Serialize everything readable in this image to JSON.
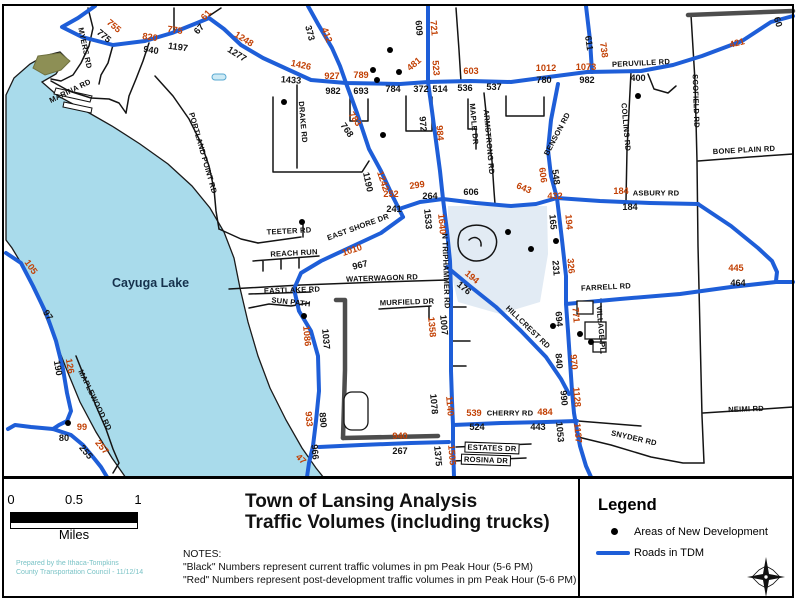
{
  "colors": {
    "roads_tdm_blue": "#1e5ed8",
    "current_volume_black": "#141414",
    "post_development_red": "#c24105",
    "lake_fill": "#a9dbeb",
    "boundary_gray": "#4d4d4d",
    "credit_teal": "#7ac3c6",
    "development_shade": "#e2ebf4"
  },
  "map": {
    "lake_label": "Cayuga Lake",
    "road_labels": [
      {
        "t": "MYERS RD",
        "x": 85,
        "y": 48,
        "r": 78
      },
      {
        "t": "MARINA RD",
        "x": 70,
        "y": 91,
        "r": -26
      },
      {
        "t": "PORTLAND POINT RD",
        "x": 203,
        "y": 153,
        "r": 74
      },
      {
        "t": "DRAKE RD",
        "x": 303,
        "y": 122,
        "r": 85
      },
      {
        "t": "TEETER RD",
        "x": 289,
        "y": 231,
        "r": -3
      },
      {
        "t": "EAST SHORE DR",
        "x": 358,
        "y": 227,
        "r": -20
      },
      {
        "t": "REACH RUN",
        "x": 294,
        "y": 253,
        "r": -3
      },
      {
        "t": "EASTLAKE RD",
        "x": 292,
        "y": 290,
        "r": -2
      },
      {
        "t": "SUN PATH",
        "x": 291,
        "y": 302,
        "r": 6
      },
      {
        "t": "WATERWAGON RD",
        "x": 382,
        "y": 278,
        "r": -2
      },
      {
        "t": "MURFIELD DR",
        "x": 407,
        "y": 302,
        "r": -2
      },
      {
        "t": "MAPLE DR",
        "x": 474,
        "y": 124,
        "r": 85
      },
      {
        "t": "ARMSTRONG RD",
        "x": 489,
        "y": 142,
        "r": 85
      },
      {
        "t": "BENSON RD",
        "x": 557,
        "y": 134,
        "r": -62
      },
      {
        "t": "COLLINS RD",
        "x": 626,
        "y": 127,
        "r": 85
      },
      {
        "t": "SCOFIELD RD",
        "x": 696,
        "y": 101,
        "r": 88
      },
      {
        "t": "PERUVILLE RD",
        "x": 641,
        "y": 63,
        "r": -3
      },
      {
        "t": "BONE PLAIN RD",
        "x": 744,
        "y": 150,
        "r": -3
      },
      {
        "t": "ASBURY RD",
        "x": 656,
        "y": 193,
        "r": 0
      },
      {
        "t": "FARRELL RD",
        "x": 606,
        "y": 287,
        "r": -3
      },
      {
        "t": "VILLAGE PL",
        "x": 601,
        "y": 329,
        "r": 85
      },
      {
        "t": "HILLCREST RD",
        "x": 528,
        "y": 327,
        "r": 44
      },
      {
        "t": "CHERRY RD",
        "x": 510,
        "y": 413,
        "r": 0
      },
      {
        "t": "SNYDER RD",
        "x": 634,
        "y": 438,
        "r": 13
      },
      {
        "t": "NEIMI RD",
        "x": 746,
        "y": 409,
        "r": -2
      },
      {
        "t": "ESTATES DR",
        "x": 492,
        "y": 448,
        "r": 2,
        "box": true
      },
      {
        "t": "ROSINA DR",
        "x": 486,
        "y": 460,
        "r": 2,
        "box": true
      },
      {
        "t": "MAPLEWOOD RD",
        "x": 95,
        "y": 400,
        "r": 64
      },
      {
        "t": "N TRIPHAMMER RD",
        "x": 446,
        "y": 271,
        "r": 88
      }
    ],
    "traffic_numbers": [
      {
        "v": "755",
        "c": "r",
        "x": 114,
        "y": 26,
        "r": 40
      },
      {
        "v": "775",
        "c": "b",
        "x": 104,
        "y": 36,
        "r": 40
      },
      {
        "v": "820",
        "c": "r",
        "x": 150,
        "y": 37,
        "r": 8
      },
      {
        "v": "775",
        "c": "r",
        "x": 175,
        "y": 30,
        "r": 8
      },
      {
        "v": "940",
        "c": "b",
        "x": 151,
        "y": 50,
        "r": 8
      },
      {
        "v": "1197",
        "c": "b",
        "x": 178,
        "y": 47,
        "r": 8
      },
      {
        "v": "61",
        "c": "r",
        "x": 206,
        "y": 15,
        "r": -48
      },
      {
        "v": "67",
        "c": "b",
        "x": 199,
        "y": 29,
        "r": -48
      },
      {
        "v": "1248",
        "c": "r",
        "x": 244,
        "y": 39,
        "r": 32
      },
      {
        "v": "1277",
        "c": "b",
        "x": 237,
        "y": 54,
        "r": 32
      },
      {
        "v": "373",
        "c": "b",
        "x": 310,
        "y": 33,
        "r": 75
      },
      {
        "v": "412",
        "c": "r",
        "x": 327,
        "y": 35,
        "r": 70
      },
      {
        "v": "609",
        "c": "b",
        "x": 419,
        "y": 28,
        "r": 85
      },
      {
        "v": "721",
        "c": "r",
        "x": 434,
        "y": 28,
        "r": 85
      },
      {
        "v": "1426",
        "c": "r",
        "x": 301,
        "y": 65,
        "r": 12
      },
      {
        "v": "1433",
        "c": "b",
        "x": 291,
        "y": 80,
        "r": 4
      },
      {
        "v": "927",
        "c": "r",
        "x": 332,
        "y": 76,
        "r": 0
      },
      {
        "v": "982",
        "c": "b",
        "x": 333,
        "y": 91,
        "r": 0
      },
      {
        "v": "789",
        "c": "r",
        "x": 361,
        "y": 75,
        "r": 0
      },
      {
        "v": "693",
        "c": "b",
        "x": 361,
        "y": 91,
        "r": 0
      },
      {
        "v": "784",
        "c": "b",
        "x": 393,
        "y": 89,
        "r": 0
      },
      {
        "v": "481",
        "c": "r",
        "x": 414,
        "y": 64,
        "r": -40
      },
      {
        "v": "372",
        "c": "b",
        "x": 421,
        "y": 89,
        "r": 0
      },
      {
        "v": "523",
        "c": "r",
        "x": 436,
        "y": 68,
        "r": 85
      },
      {
        "v": "514",
        "c": "b",
        "x": 440,
        "y": 89,
        "r": 0
      },
      {
        "v": "536",
        "c": "b",
        "x": 465,
        "y": 88,
        "r": 0
      },
      {
        "v": "603",
        "c": "r",
        "x": 471,
        "y": 71,
        "r": 0
      },
      {
        "v": "537",
        "c": "b",
        "x": 494,
        "y": 87,
        "r": 0
      },
      {
        "v": "1012",
        "c": "r",
        "x": 546,
        "y": 68,
        "r": 0
      },
      {
        "v": "780",
        "c": "b",
        "x": 544,
        "y": 80,
        "r": 0
      },
      {
        "v": "1073",
        "c": "r",
        "x": 586,
        "y": 67,
        "r": 0
      },
      {
        "v": "982",
        "c": "b",
        "x": 587,
        "y": 80,
        "r": 0
      },
      {
        "v": "611",
        "c": "b",
        "x": 589,
        "y": 43,
        "r": 82
      },
      {
        "v": "738",
        "c": "r",
        "x": 604,
        "y": 50,
        "r": 82
      },
      {
        "v": "421",
        "c": "r",
        "x": 737,
        "y": 43,
        "r": -15
      },
      {
        "v": "60",
        "c": "b",
        "x": 778,
        "y": 22,
        "r": 72
      },
      {
        "v": "400",
        "c": "b",
        "x": 638,
        "y": 78,
        "r": 0
      },
      {
        "v": "783",
        "c": "r",
        "x": 355,
        "y": 119,
        "r": 55
      },
      {
        "v": "768",
        "c": "b",
        "x": 347,
        "y": 130,
        "r": 55
      },
      {
        "v": "972",
        "c": "b",
        "x": 423,
        "y": 124,
        "r": 85
      },
      {
        "v": "984",
        "c": "r",
        "x": 440,
        "y": 133,
        "r": 85
      },
      {
        "v": "1190",
        "c": "b",
        "x": 368,
        "y": 182,
        "r": 78
      },
      {
        "v": "1242",
        "c": "r",
        "x": 383,
        "y": 181,
        "r": 72
      },
      {
        "v": "252",
        "c": "r",
        "x": 391,
        "y": 194,
        "r": 0
      },
      {
        "v": "299",
        "c": "r",
        "x": 417,
        "y": 185,
        "r": -8
      },
      {
        "v": "241",
        "c": "b",
        "x": 394,
        "y": 209,
        "r": 0
      },
      {
        "v": "264",
        "c": "b",
        "x": 430,
        "y": 196,
        "r": 0
      },
      {
        "v": "1533",
        "c": "b",
        "x": 428,
        "y": 219,
        "r": 85
      },
      {
        "v": "1640",
        "c": "r",
        "x": 442,
        "y": 224,
        "r": 85
      },
      {
        "v": "606",
        "c": "b",
        "x": 471,
        "y": 192,
        "r": 0
      },
      {
        "v": "643",
        "c": "r",
        "x": 524,
        "y": 188,
        "r": 22
      },
      {
        "v": "606",
        "c": "r",
        "x": 543,
        "y": 175,
        "r": 82
      },
      {
        "v": "548",
        "c": "b",
        "x": 556,
        "y": 177,
        "r": 82
      },
      {
        "v": "432",
        "c": "r",
        "x": 555,
        "y": 196,
        "r": 0
      },
      {
        "v": "184",
        "c": "r",
        "x": 621,
        "y": 191,
        "r": 0
      },
      {
        "v": "184",
        "c": "b",
        "x": 630,
        "y": 207,
        "r": 0
      },
      {
        "v": "165",
        "c": "b",
        "x": 553,
        "y": 222,
        "r": 85
      },
      {
        "v": "194",
        "c": "r",
        "x": 569,
        "y": 222,
        "r": 85
      },
      {
        "v": "231",
        "c": "b",
        "x": 556,
        "y": 268,
        "r": 85
      },
      {
        "v": "326",
        "c": "r",
        "x": 571,
        "y": 266,
        "r": 85
      },
      {
        "v": "445",
        "c": "r",
        "x": 736,
        "y": 268,
        "r": 0
      },
      {
        "v": "464",
        "c": "b",
        "x": 738,
        "y": 283,
        "r": 0
      },
      {
        "v": "1010",
        "c": "r",
        "x": 352,
        "y": 250,
        "r": -18
      },
      {
        "v": "967",
        "c": "b",
        "x": 360,
        "y": 265,
        "r": -14
      },
      {
        "v": "194",
        "c": "r",
        "x": 472,
        "y": 277,
        "r": 40
      },
      {
        "v": "176",
        "c": "b",
        "x": 464,
        "y": 288,
        "r": 40
      },
      {
        "v": "1358",
        "c": "r",
        "x": 432,
        "y": 327,
        "r": 85
      },
      {
        "v": "1007",
        "c": "b",
        "x": 444,
        "y": 325,
        "r": 85
      },
      {
        "v": "1086",
        "c": "r",
        "x": 307,
        "y": 336,
        "r": 85
      },
      {
        "v": "1037",
        "c": "b",
        "x": 326,
        "y": 339,
        "r": 85
      },
      {
        "v": "933",
        "c": "r",
        "x": 309,
        "y": 419,
        "r": 85
      },
      {
        "v": "890",
        "c": "b",
        "x": 323,
        "y": 420,
        "r": 85
      },
      {
        "v": "966",
        "c": "b",
        "x": 315,
        "y": 452,
        "r": 85
      },
      {
        "v": "47",
        "c": "r",
        "x": 301,
        "y": 459,
        "r": 45
      },
      {
        "v": "105",
        "c": "r",
        "x": 31,
        "y": 267,
        "r": 55
      },
      {
        "v": "97",
        "c": "b",
        "x": 48,
        "y": 315,
        "r": 55
      },
      {
        "v": "190",
        "c": "b",
        "x": 58,
        "y": 368,
        "r": 80
      },
      {
        "v": "126",
        "c": "r",
        "x": 70,
        "y": 366,
        "r": 80
      },
      {
        "v": "99",
        "c": "r",
        "x": 82,
        "y": 427,
        "r": 0
      },
      {
        "v": "80",
        "c": "b",
        "x": 64,
        "y": 438,
        "r": 0
      },
      {
        "v": "255",
        "c": "b",
        "x": 86,
        "y": 452,
        "r": 50
      },
      {
        "v": "257",
        "c": "r",
        "x": 102,
        "y": 447,
        "r": 50
      },
      {
        "v": "940",
        "c": "r",
        "x": 400,
        "y": 436,
        "r": 0
      },
      {
        "v": "267",
        "c": "b",
        "x": 400,
        "y": 451,
        "r": 0
      },
      {
        "v": "1078",
        "c": "b",
        "x": 434,
        "y": 404,
        "r": 85
      },
      {
        "v": "1140",
        "c": "r",
        "x": 450,
        "y": 406,
        "r": 85
      },
      {
        "v": "1375",
        "c": "b",
        "x": 438,
        "y": 456,
        "r": 85
      },
      {
        "v": "1505",
        "c": "r",
        "x": 452,
        "y": 455,
        "r": 85
      },
      {
        "v": "539",
        "c": "r",
        "x": 474,
        "y": 413,
        "r": 0
      },
      {
        "v": "484",
        "c": "r",
        "x": 545,
        "y": 412,
        "r": 0
      },
      {
        "v": "524",
        "c": "b",
        "x": 477,
        "y": 427,
        "r": 0
      },
      {
        "v": "443",
        "c": "b",
        "x": 538,
        "y": 427,
        "r": 0
      },
      {
        "v": "694",
        "c": "b",
        "x": 559,
        "y": 319,
        "r": 85
      },
      {
        "v": "771",
        "c": "r",
        "x": 576,
        "y": 315,
        "r": 85
      },
      {
        "v": "840",
        "c": "b",
        "x": 559,
        "y": 361,
        "r": 85
      },
      {
        "v": "970",
        "c": "r",
        "x": 574,
        "y": 362,
        "r": 85
      },
      {
        "v": "990",
        "c": "b",
        "x": 564,
        "y": 398,
        "r": 85
      },
      {
        "v": "1128",
        "c": "r",
        "x": 577,
        "y": 397,
        "r": 85
      },
      {
        "v": "1053",
        "c": "b",
        "x": 560,
        "y": 432,
        "r": 85
      },
      {
        "v": "1137",
        "c": "r",
        "x": 578,
        "y": 433,
        "r": 85
      }
    ],
    "dev_dots": [
      [
        390,
        50
      ],
      [
        373,
        70
      ],
      [
        399,
        72
      ],
      [
        377,
        80
      ],
      [
        284,
        102
      ],
      [
        383,
        135
      ],
      [
        638,
        96
      ],
      [
        302,
        222
      ],
      [
        304,
        316
      ],
      [
        508,
        232
      ],
      [
        531,
        249
      ],
      [
        556,
        241
      ],
      [
        553,
        326
      ],
      [
        580,
        334
      ],
      [
        591,
        342
      ],
      [
        68,
        423
      ]
    ]
  },
  "footer": {
    "scale": {
      "ticks": [
        "0",
        "0.5",
        "1"
      ],
      "unit": "Miles"
    },
    "credit": [
      "Prepared by the Ithaca-Tompkins",
      "County Transportation Council - 11/12/14"
    ],
    "title_lines": [
      "Town of Lansing Analysis",
      "Traffic Volumes (including trucks)"
    ],
    "notes_heading": "NOTES:",
    "notes": [
      "\"Black\" Numbers represent current traffic volumes in pm Peak Hour (5-6 PM)",
      "\"Red\" Numbers represent post-development traffic volumes in pm Peak Hour (5-6 PM)"
    ],
    "legend": {
      "heading": "Legend",
      "items": [
        {
          "label": "Areas of New Development",
          "marker": "development-dot"
        },
        {
          "label": "Roads in TDM",
          "marker": "tdm-road-line"
        }
      ]
    },
    "compass_icon": "compass-rose-icon"
  }
}
